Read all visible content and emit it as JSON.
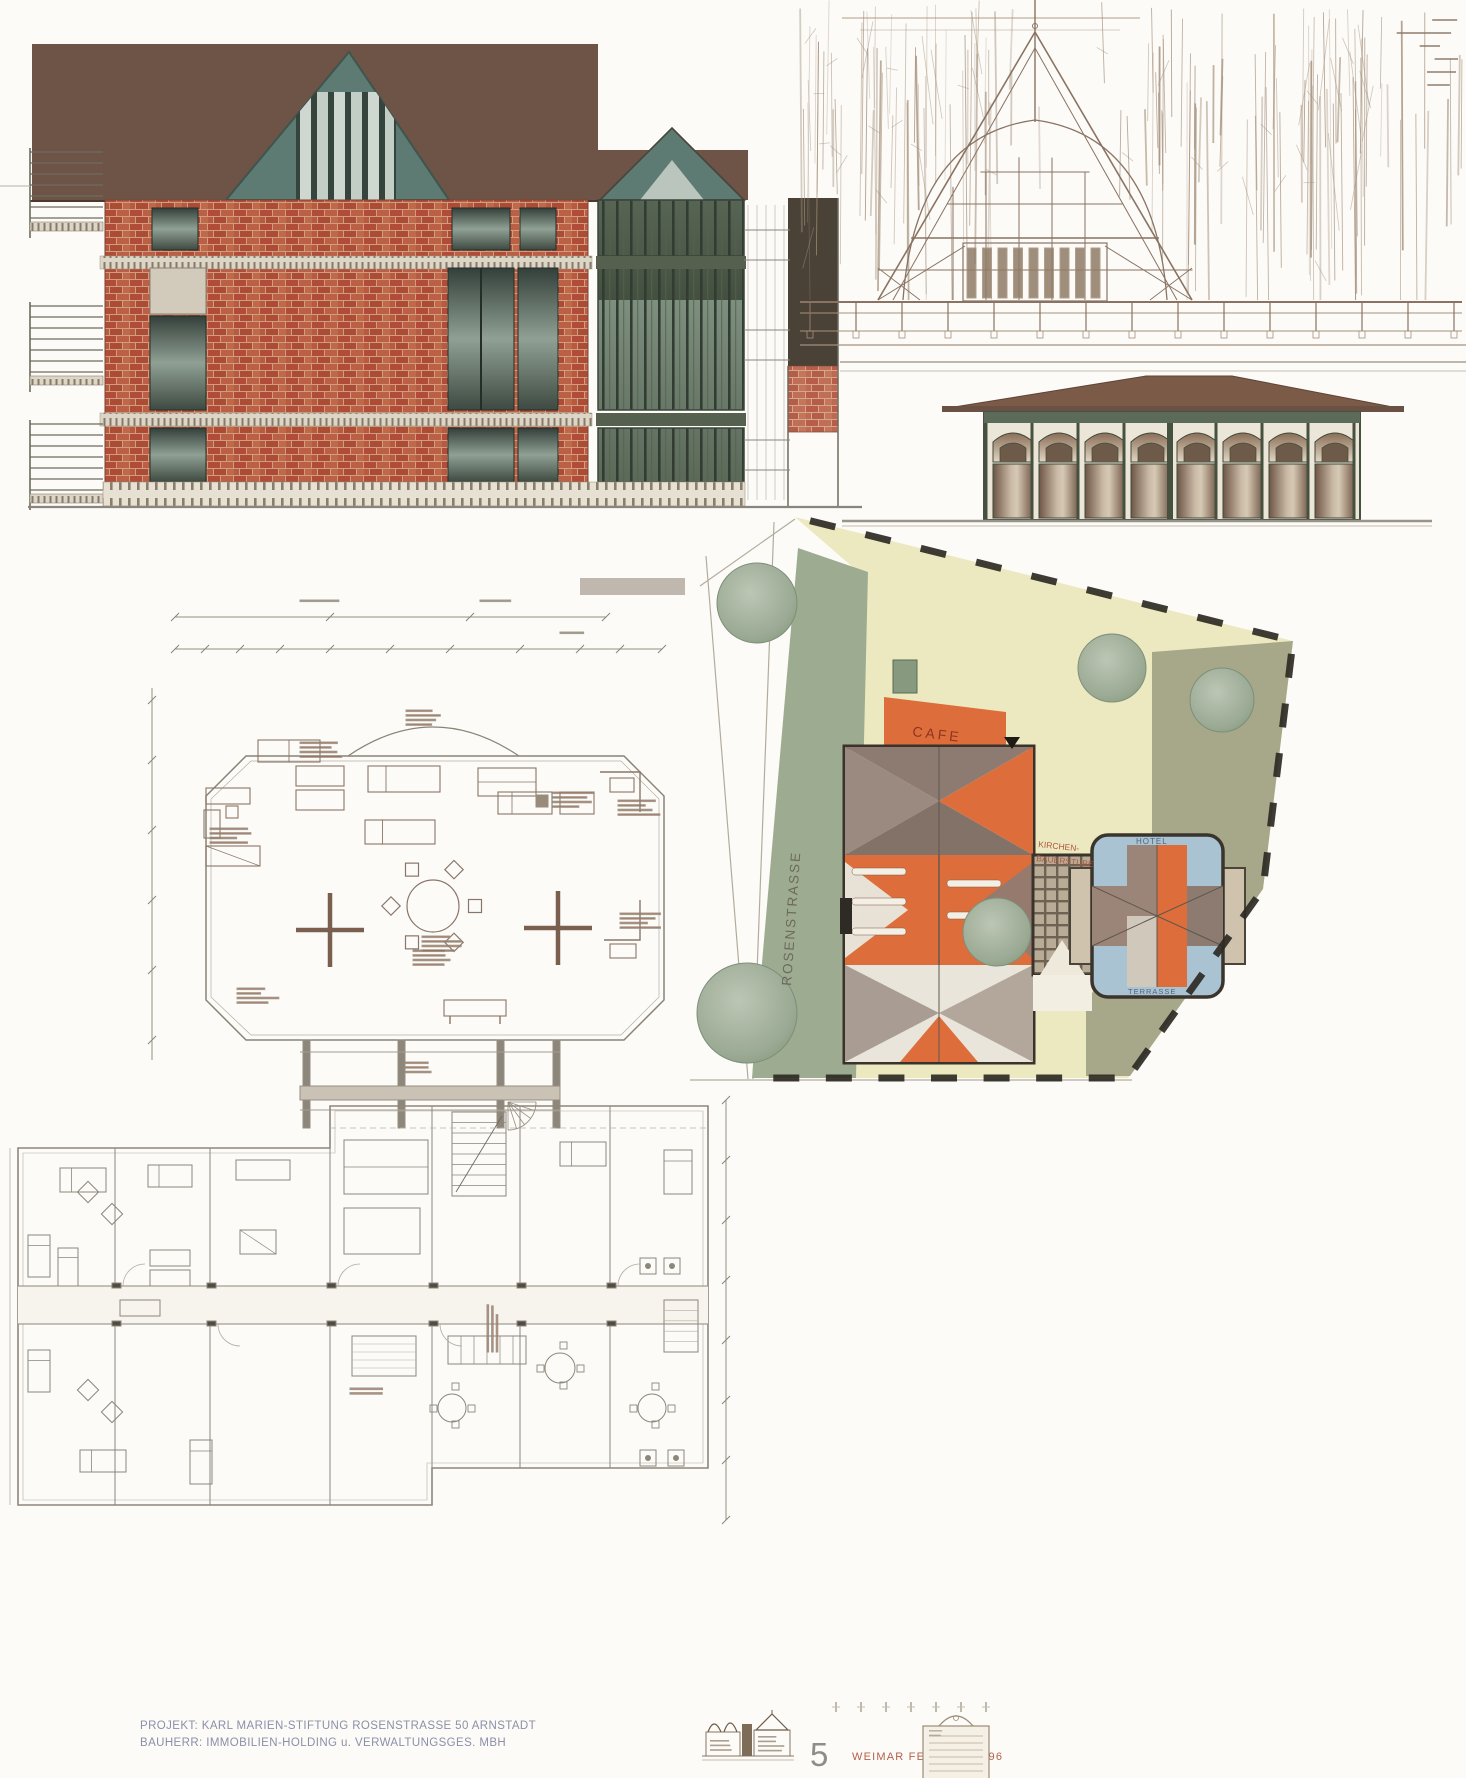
{
  "sheet": {
    "title_block": {
      "project_line": "PROJEKT: KARL MARIEN-STIFTUNG ROSENSTRASSE 50 ARNSTADT",
      "client_line": "BAUHERR: IMMOBILIEN-HOLDING u. VERWALTUNGSGES. MBH",
      "sheet_number": "5",
      "issue_line": "WEIMAR FEBRUAR 1996"
    },
    "site_plan": {
      "street_label": "ROSENSTRASSE",
      "cafe_label": "CAFE",
      "hotel_label": "HOTEL",
      "terrace_label": "TERRASSE",
      "annex_label_line1": "KIRCHEN-",
      "annex_label_line2": "BAUERSTUBE",
      "colors": {
        "courtyard": "#ece9c1",
        "lawn": "#a7a88a",
        "verge": "#9dac91",
        "roof_orange": "#dd6e3c",
        "roof_gray": "#8d7b72",
        "terrace_blue": "#a9c3d3",
        "tree_green": "#97a893"
      }
    },
    "elevations": {
      "colors": {
        "roof_brown": "#6e5347",
        "gable_teal": "#5e7b73",
        "brick_red": "#b5533d",
        "glazing_green": "#54604f"
      }
    }
  }
}
